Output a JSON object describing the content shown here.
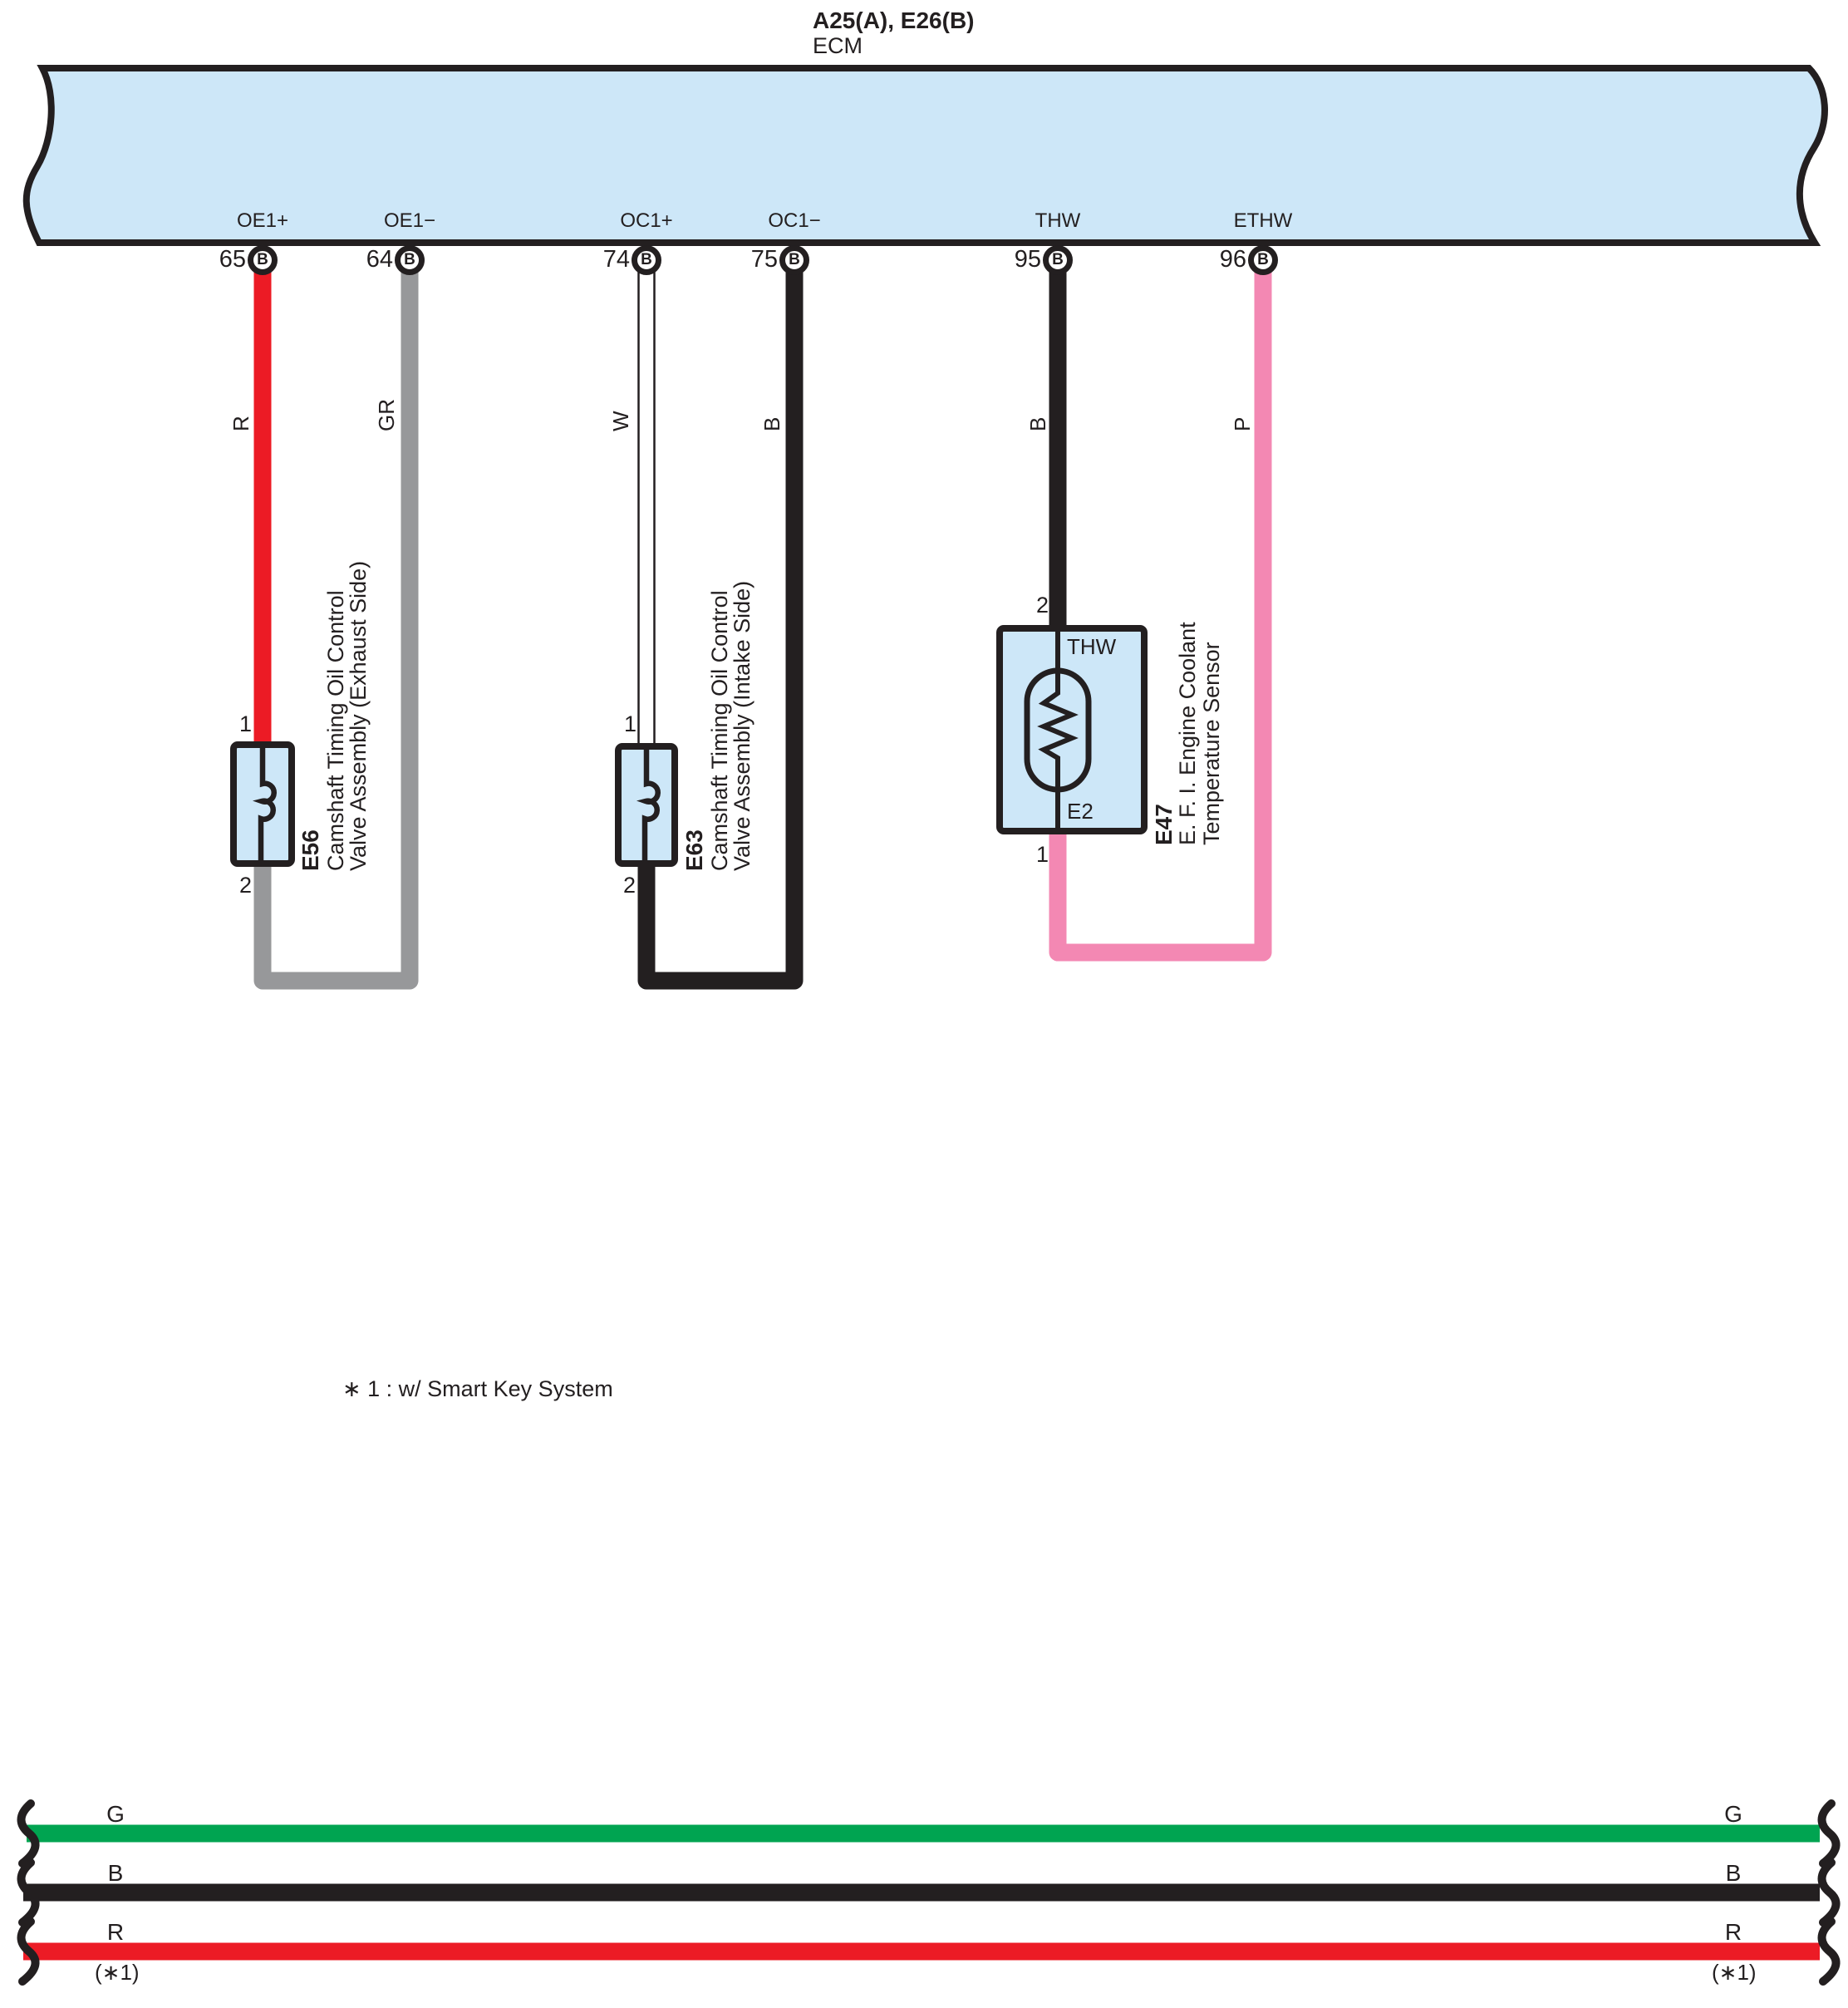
{
  "diagram_title": {
    "connectors": "A25(A), E26(B)",
    "module": "ECM"
  },
  "note": "∗ 1 : w/ Smart Key System",
  "ecm_pins": [
    {
      "label": "OE1+",
      "number": "65",
      "terminal": "B",
      "wire_color_code": "R"
    },
    {
      "label": "OE1−",
      "number": "64",
      "terminal": "B",
      "wire_color_code": "GR"
    },
    {
      "label": "OC1+",
      "number": "74",
      "terminal": "B",
      "wire_color_code": "W"
    },
    {
      "label": "OC1−",
      "number": "75",
      "terminal": "B",
      "wire_color_code": "B"
    },
    {
      "label": "THW",
      "number": "95",
      "terminal": "B",
      "wire_color_code": "B"
    },
    {
      "label": "ETHW",
      "number": "96",
      "terminal": "B",
      "wire_color_code": "P"
    }
  ],
  "components": [
    {
      "code": "E56",
      "name_line1": "Camshaft Timing Oil Control",
      "name_line2": "Valve Assembly (Exhaust Side)",
      "pin_top": "1",
      "pin_bottom": "2"
    },
    {
      "code": "E63",
      "name_line1": "Camshaft Timing Oil Control",
      "name_line2": "Valve Assembly (Intake Side)",
      "pin_top": "1",
      "pin_bottom": "2"
    },
    {
      "code": "E47",
      "name_line1": "E. F. I. Engine Coolant",
      "name_line2": "Temperature Sensor",
      "pin_top": "2",
      "pin_bottom": "1",
      "terminal_top": "THW",
      "terminal_bottom": "E2"
    }
  ],
  "bus_wires": [
    {
      "label": "G",
      "note": ""
    },
    {
      "label": "B",
      "note": ""
    },
    {
      "label": "R",
      "note": "(∗1)"
    }
  ],
  "colors": {
    "panel_blue": "#CDE7F8",
    "line_black": "#231F20",
    "red": "#EC1B25",
    "gray": "#97989A",
    "pink": "#F388B3",
    "green": "#00A451",
    "white": "#FFFFFF"
  }
}
